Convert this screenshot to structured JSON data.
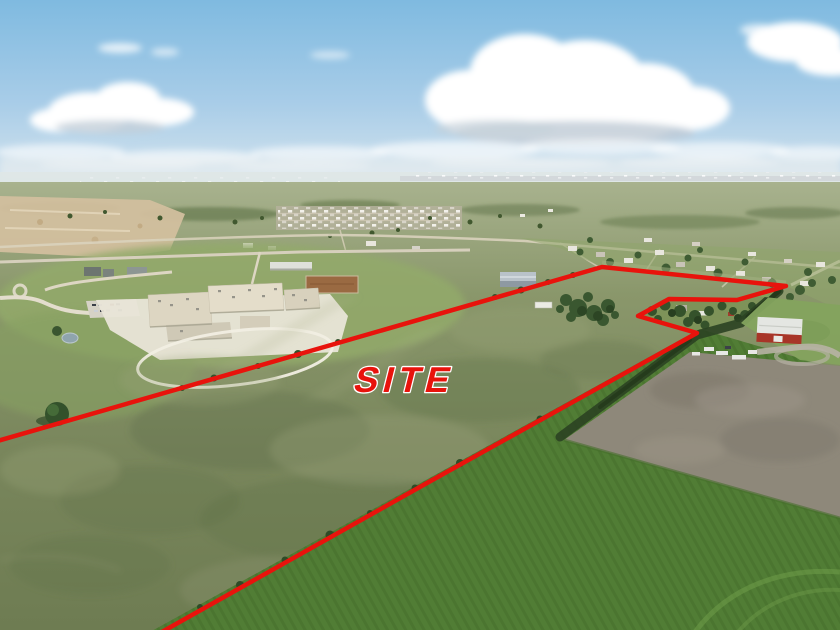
{
  "annotation": {
    "site_label": "SITE",
    "boundary_color": "#e8130c",
    "label_fill": "#e8130c",
    "label_outline": "#ffffff"
  },
  "palette": {
    "sky_top": "#7fbae0",
    "sky_horizon": "#d8e6ee",
    "cloud_white": "#ffffff",
    "pasture_green": "#77835d",
    "corn_green": "#517d35",
    "plowed_dirt": "#8e887a",
    "construction_tan": "#d2bf9e",
    "concrete": "#e9e5d8",
    "barn_red": "#a83528",
    "barn_roof": "#e4e6e2"
  },
  "scene": {
    "description": "Aerial drone photograph of a rural land parcel outlined in red, labeled SITE; school campus at left, housing subdivision and construction at the horizon, homesteads along the top boundary, red barn at right, corn field and plowed field in the foreground."
  }
}
